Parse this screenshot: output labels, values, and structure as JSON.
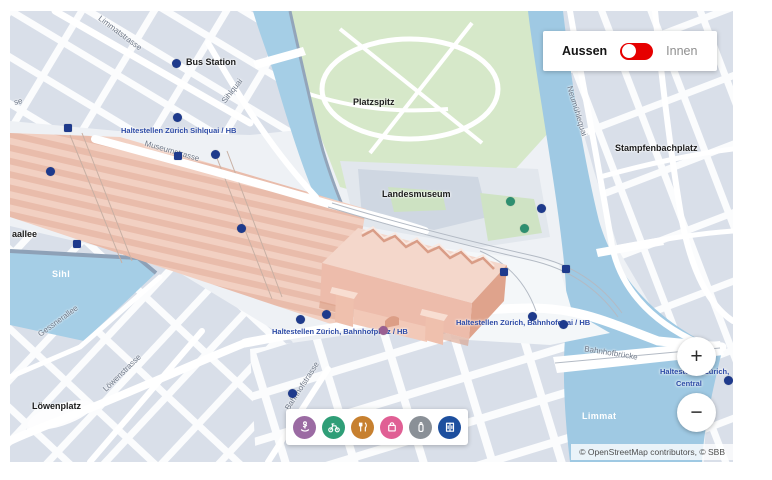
{
  "toggle": {
    "left_label": "Aussen",
    "right_label": "Innen",
    "state": "left",
    "switch_color": "#e60000"
  },
  "map": {
    "attribution": "© OpenStreetMap contributors, © SBB",
    "controls": {
      "zoom_in": "+",
      "zoom_out": "−"
    },
    "place_labels": {
      "bus_station": "Bus Station",
      "platzspitz": "Platzspitz",
      "landesmuseum": "Landesmuseum",
      "stampfenbachplatz": "Stampfenbachplatz",
      "loewenplatz": "Löwenplatz",
      "allee_fragment": "aallee",
      "strasse_fragment": "se"
    },
    "water_labels": {
      "sihl": "Sihl",
      "limmat": "Limmat"
    },
    "street_labels": {
      "limmatstrasse": "Limmatstrasse",
      "sihlquai": "Sihlquai",
      "museumstrasse": "Museumstrasse",
      "neumuehlequai": "Neumühlequai",
      "gessnerallee": "Gessnerallee",
      "loewenstrasse": "Löwenstrasse",
      "bahnhofstrasse": "Bahnhofstrasse",
      "bahnhofbruecke": "Bahnhofbrücke"
    },
    "transit_labels": {
      "sihlquai_hb": "Haltestellen Zürich Sihlquai / HB",
      "bahnhofplatz_hb": "Haltestellen Zürich, Bahnhofplatz / HB",
      "bahnhofquai_hb": "Haltestellen Zürich, Bahnhofquai / HB",
      "central_line1": "Haltestellen Zürich,",
      "central_line2": "Central"
    },
    "marker_colors": {
      "stop": "#1e3a8c",
      "entrance": "#1e3a8c",
      "poi-green": "#2e8f70",
      "poi-purple": "#9a5f92"
    },
    "markers": [
      {
        "x": 166,
        "y": 52,
        "shape": "circle",
        "kind": "stop"
      },
      {
        "x": 167,
        "y": 106,
        "shape": "circle",
        "kind": "stop"
      },
      {
        "x": 205,
        "y": 143,
        "shape": "circle",
        "kind": "stop"
      },
      {
        "x": 231,
        "y": 217,
        "shape": "circle",
        "kind": "stop"
      },
      {
        "x": 531,
        "y": 197,
        "shape": "circle",
        "kind": "stop"
      },
      {
        "x": 290,
        "y": 308,
        "shape": "circle",
        "kind": "stop"
      },
      {
        "x": 316,
        "y": 303,
        "shape": "circle",
        "kind": "stop"
      },
      {
        "x": 522,
        "y": 305,
        "shape": "circle",
        "kind": "stop"
      },
      {
        "x": 553,
        "y": 313,
        "shape": "circle",
        "kind": "stop"
      },
      {
        "x": 282,
        "y": 382,
        "shape": "circle",
        "kind": "stop"
      },
      {
        "x": 718,
        "y": 369,
        "shape": "circle",
        "kind": "stop"
      },
      {
        "x": 40,
        "y": 160,
        "shape": "circle",
        "kind": "stop"
      },
      {
        "x": 58,
        "y": 117,
        "shape": "square",
        "kind": "entrance"
      },
      {
        "x": 168,
        "y": 145,
        "shape": "square",
        "kind": "entrance"
      },
      {
        "x": 67,
        "y": 233,
        "shape": "square",
        "kind": "entrance"
      },
      {
        "x": 494,
        "y": 261,
        "shape": "square",
        "kind": "entrance"
      },
      {
        "x": 556,
        "y": 258,
        "shape": "square",
        "kind": "entrance"
      },
      {
        "x": 500,
        "y": 190,
        "shape": "circle",
        "kind": "poi-green"
      },
      {
        "x": 514,
        "y": 217,
        "shape": "circle",
        "kind": "poi-green"
      },
      {
        "x": 373,
        "y": 319,
        "shape": "circle",
        "kind": "poi-purple"
      }
    ],
    "filters": [
      {
        "name": "services",
        "color": "#9b6ba3"
      },
      {
        "name": "bike-mobility",
        "color": "#2f9e77"
      },
      {
        "name": "gastronomy",
        "color": "#c7802f"
      },
      {
        "name": "shopping",
        "color": "#e05f94"
      },
      {
        "name": "luggage",
        "color": "#8a9097"
      },
      {
        "name": "elevator",
        "color": "#1d4f9e"
      }
    ]
  }
}
